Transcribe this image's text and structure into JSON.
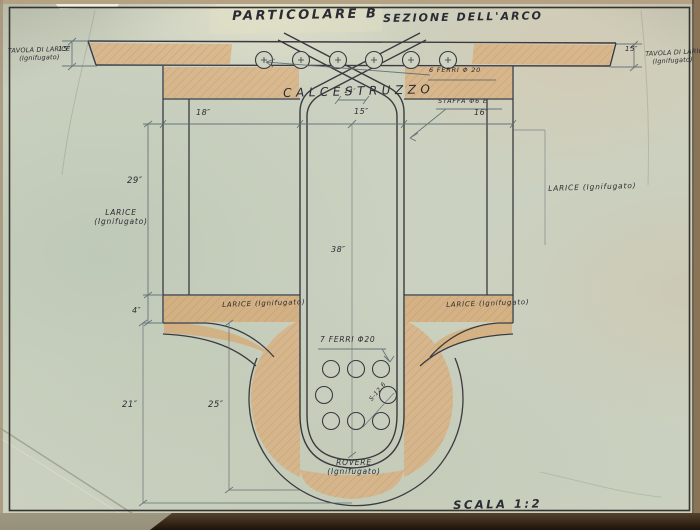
{
  "title": {
    "left": "PARTICOLARE  B",
    "right": "SEZIONE  DELL'ARCO"
  },
  "materials": {
    "calcestruzzo": "CALCESTRUZZO",
    "staffa": "STAFFA Φ6 E",
    "ferri_top": "6 FERRI Φ 20",
    "ferri_bottom": "7 FERRI Φ20",
    "spacing_note": "S-12.6",
    "tavola_left": [
      "TAVOLA DI LARICE",
      "(Ignifugato)"
    ],
    "tavola_right": [
      "TAVOLA DI LARICE",
      "(Ignifugato)"
    ],
    "larice_left": [
      "LARICE",
      "(Ignifugato)"
    ],
    "larice_right": "LARICE (Ignifugato)",
    "larice_band_left": "LARICE (Ignifugato)",
    "larice_band_right": "LARICE (Ignifugato)",
    "rovere": [
      "ROVERE",
      "(Ignifugato)"
    ]
  },
  "dimensions": {
    "slab_left": "15″",
    "slab_right": "15″",
    "row_left": "18″",
    "row_center": "15″",
    "row_right": "16″",
    "neck": "14″",
    "wall_height": "29″",
    "band_thickness": "4″",
    "stem_height": "38″",
    "block_left": "21″",
    "block_inner": "25″"
  },
  "footer": {
    "scale": "SCALA 1:2"
  },
  "colors": {
    "paper": "#cbd1c0",
    "ink": "#3a3a40",
    "timber_fill": "#dcae7b",
    "hatch": "#b3804a",
    "dimension": "#5d6c74",
    "photo_edge": "#2a1c10"
  }
}
